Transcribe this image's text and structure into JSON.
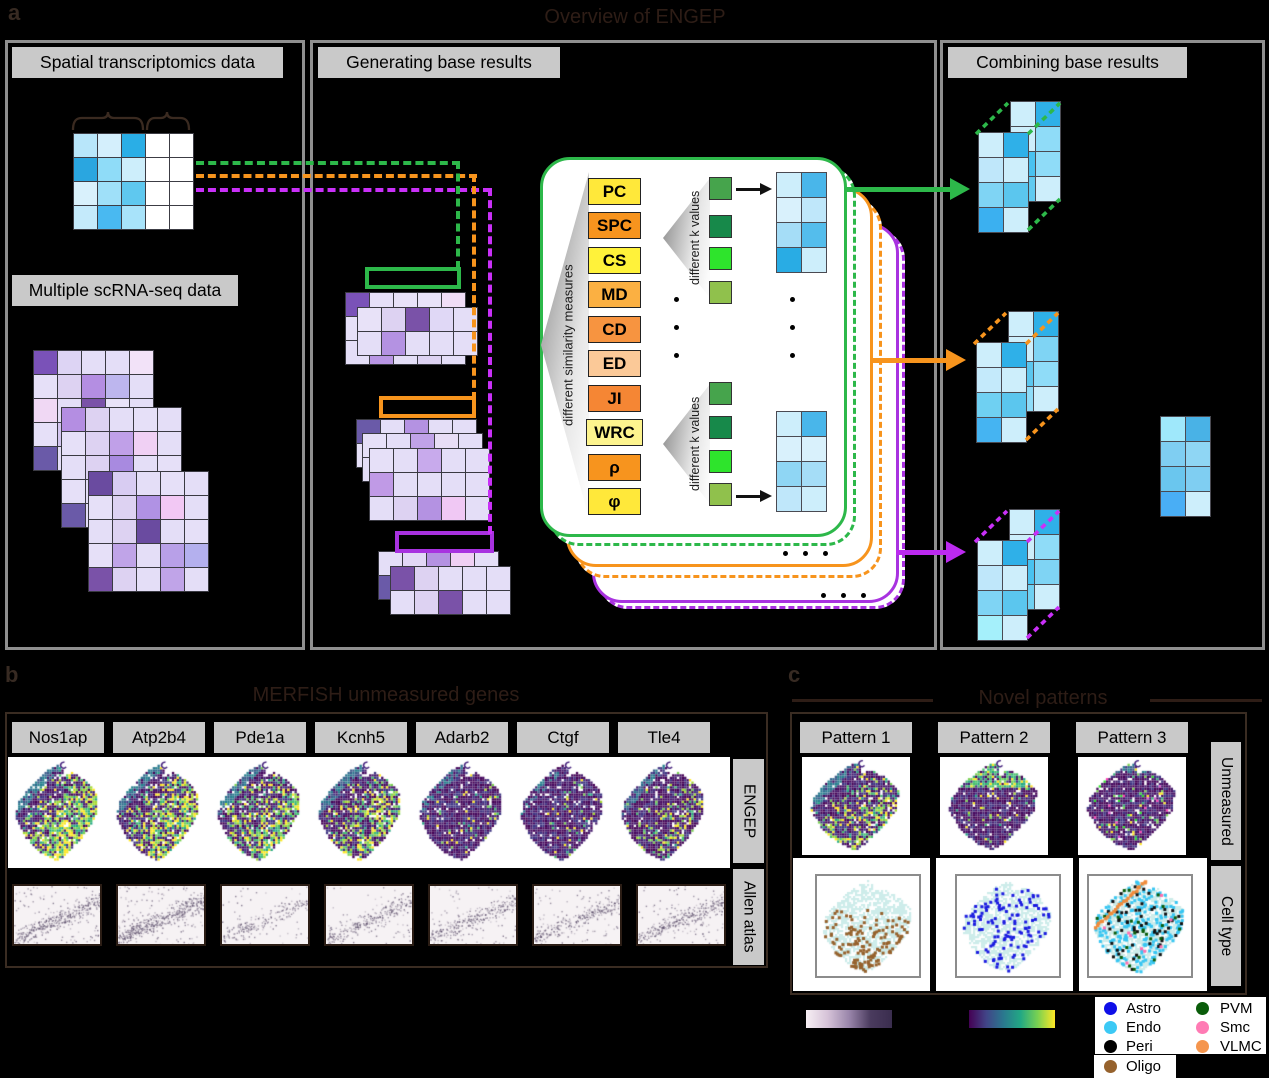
{
  "panel_a": {
    "label": "a",
    "title": "Overview of ENGEP",
    "colors": {
      "green": "#2db84a",
      "orange": "#f7941d",
      "purple": "#a832e0",
      "purple_bright": "#c930f8"
    },
    "left": {
      "title": "Spatial transcriptomics data",
      "scrna_title": "Multiple scRNA-seq data",
      "spatial_matrix": [
        [
          "#b8e6fa",
          "#d4effc",
          "#2aaee6",
          "#ffffff",
          "#ffffff"
        ],
        [
          "#2aa6e0",
          "#8fdcf8",
          "#cdeefb",
          "#ffffff",
          "#ffffff"
        ],
        [
          "#d9f1fc",
          "#9fe0f9",
          "#5fc8ef",
          "#ffffff",
          "#ffffff"
        ],
        [
          "#c4eafb",
          "#49b9f1",
          "#a8e3fa",
          "#ffffff",
          "#ffffff"
        ]
      ],
      "scrna_matrices": [
        [
          [
            "#7a52b8",
            "#ddd4f4",
            "#e4def7",
            "#e4def7",
            "#f2e2f8"
          ],
          [
            "#e6e0f8",
            "#ddd2f2",
            "#b48ee2",
            "#bdb6ee",
            "#e4def7"
          ],
          [
            "#f0d8f4",
            "#e4def7",
            "#7a52a8",
            "#e8e2f8",
            "#e4def7"
          ],
          [
            "#e6e0f8",
            "#d4c6f0",
            "#e4def7",
            "#dcd4f4",
            "#e4def7"
          ],
          [
            "#6a5aa8",
            "#e4def7",
            "#c8b4ea",
            "#e4def7",
            "#e4def7"
          ]
        ],
        [
          [
            "#b48ee2",
            "#ddd2f2",
            "#e4def7",
            "#e6e0f8",
            "#e4def7"
          ],
          [
            "#e6e0f8",
            "#ddd2f2",
            "#c0a0e8",
            "#f0d0f4",
            "#e4def7"
          ],
          [
            "#e4def7",
            "#ddd2f2",
            "#a88ae0",
            "#e4def7",
            "#e6e0f8"
          ],
          [
            "#e6e0f8",
            "#e4def7",
            "#e4def7",
            "#ddd2f2",
            "#e4def7"
          ],
          [
            "#6a5aa8",
            "#e4def7",
            "#e4def7",
            "#d0c2ee",
            "#e4def7"
          ]
        ],
        [
          [
            "#6a4ba0",
            "#d8ccf2",
            "#e4def7",
            "#e6e0f8",
            "#e4def7"
          ],
          [
            "#e6e0f8",
            "#ddd2f2",
            "#b092e4",
            "#f2c8f4",
            "#e4def7"
          ],
          [
            "#e4def7",
            "#ddd2f2",
            "#6a4ba0",
            "#e4def7",
            "#e6e0f8"
          ],
          [
            "#e6e0f8",
            "#c0a4e8",
            "#e4def7",
            "#b8a0e8",
            "#b4b0ee"
          ],
          [
            "#7a52a8",
            "#ddd2f2",
            "#e4def7",
            "#c0a4e8",
            "#e4def7"
          ]
        ]
      ]
    },
    "middle": {
      "title": "Generating base results",
      "similarity_label": "different similarity measures",
      "k_label": "different k values",
      "measures": [
        {
          "label": "PC",
          "color": "#ffe83a"
        },
        {
          "label": "SPC",
          "color": "#f7941e"
        },
        {
          "label": "CS",
          "color": "#fff23a"
        },
        {
          "label": "MD",
          "color": "#fbb042"
        },
        {
          "label": "CD",
          "color": "#f79440"
        },
        {
          "label": "ED",
          "color": "#fbc998"
        },
        {
          "label": "JI",
          "color": "#f58634"
        },
        {
          "label": "WRC",
          "color": "#fdf48e"
        },
        {
          "label": "ρ",
          "color": "#f7941e"
        },
        {
          "label": "φ",
          "color": "#ffe83a"
        }
      ],
      "k_squares": [
        "#46a44c",
        "#17894a",
        "#2ee42c",
        "#90c14c"
      ],
      "k_top_matrix": [
        [
          "#cdeefb",
          "#49b6ea"
        ],
        [
          "#d9f1fc",
          "#bfe7fa"
        ],
        [
          "#a5ddf7",
          "#54bdec"
        ],
        [
          "#29ace4",
          "#cdeefb"
        ]
      ],
      "k_bottom_matrix": [
        [
          "#cdeefb",
          "#49b6ea"
        ],
        [
          "#d9f1fc",
          "#d9f1fc"
        ],
        [
          "#8fd6f4",
          "#a5ddf7"
        ],
        [
          "#bfe7fa",
          "#cdeefb"
        ]
      ],
      "stacks": [
        {
          "color": "#2db84a",
          "layers": [
            {
              "dx": 0,
              "dy": 0,
              "rows": [
                [
                  "#7a52b8",
                  "#e6e0f8",
                  "#e8e2f8",
                  "#e8e2f8",
                  "#f0ddf6"
                ],
                [
                  "#e6e0f8",
                  "#ddd2f2",
                  "#7a52a8",
                  "#e4def7",
                  "#e4def7"
                ],
                [
                  "#e4def7",
                  "#b996e4",
                  "#e4def7",
                  "#ddd2f2",
                  "#e4def7"
                ]
              ]
            },
            {
              "dx": 12,
              "dy": 15,
              "rows": [
                [
                  "#e8e2f8",
                  "#ddd2f2",
                  "#7a52a8",
                  "#e0d8f6",
                  "#e4def7"
                ],
                [
                  "#e4def7",
                  "#b492e2",
                  "#e4def7",
                  "#e4def7",
                  "#e4def7"
                ]
              ]
            }
          ]
        },
        {
          "color": "#f7941d",
          "layers": [
            {
              "dx": 0,
              "dy": 0,
              "rows": [
                [
                  "#6a5aa8",
                  "#e4def7",
                  "#b492e2",
                  "#e4def7",
                  "#e4def7"
                ],
                [
                  "#e6e0f8",
                  "#ddd2f2",
                  "#e4def7",
                  "#e4def7",
                  "#e4def7"
                ]
              ]
            },
            {
              "dx": 6,
              "dy": 14,
              "rows": [
                [
                  "#e6e0f8",
                  "#e4def7",
                  "#c0a2e8",
                  "#e8ddf6",
                  "#e4def7"
                ],
                [
                  "#e4def7",
                  "#e4def7",
                  "#e4def7",
                  "#ddd2f2",
                  "#e4def7"
                ]
              ]
            },
            {
              "dx": 13,
              "dy": 29,
              "rows": [
                [
                  "#e6e0f8",
                  "#e4def7",
                  "#c8aaec",
                  "#e4def7",
                  "#e4def7"
                ],
                [
                  "#c09ae6",
                  "#e4def7",
                  "#e4def7",
                  "#e4def7",
                  "#e4def7"
                ],
                [
                  "#e4def7",
                  "#ddd2f2",
                  "#b492e2",
                  "#f0c8f4",
                  "#e4def7"
                ]
              ]
            }
          ]
        },
        {
          "color": "#a832e0",
          "layers": [
            {
              "dx": 0,
              "dy": 0,
              "rows": [
                [
                  "#e4def7",
                  "#e2d8f6",
                  "#b492e2",
                  "#f0d0f4",
                  "#e4def7"
                ],
                [
                  "#6a5aa8",
                  "#ddd2f2",
                  "#e4def7",
                  "#e4def7",
                  "#e4def7"
                ]
              ]
            },
            {
              "dx": 12,
              "dy": 15,
              "rows": [
                [
                  "#7a52a8",
                  "#ddd2f2",
                  "#e4def7",
                  "#e4def7",
                  "#e4def7"
                ],
                [
                  "#e4def7",
                  "#ddd2f2",
                  "#7a52a8",
                  "#e4def7",
                  "#e4def7"
                ]
              ]
            }
          ]
        }
      ]
    },
    "right": {
      "title": "Combining base results",
      "result_groups": [
        {
          "color": "#2db84a",
          "back": [
            [
              "#cdeefb",
              "#2fb0e8"
            ],
            [
              "#cdeefb",
              "#8fdcf8"
            ],
            [
              "#49c2f0",
              "#8fdcf8"
            ],
            [
              "#60caf0",
              "#cdeefb"
            ]
          ],
          "front": [
            [
              "#cdeefb",
              "#2fb0e8"
            ],
            [
              "#bfe7fa",
              "#cdeefb"
            ],
            [
              "#7fd4f4",
              "#5bc6ee"
            ],
            [
              "#3bb0f0",
              "#cdeefb"
            ]
          ]
        },
        {
          "color": "#f7941d",
          "back": [
            [
              "#cdeefb",
              "#2fb0e8"
            ],
            [
              "#cdeefb",
              "#7fd4f4"
            ],
            [
              "#5bc6ee",
              "#8fdcf8"
            ],
            [
              "#8fdcf8",
              "#cdeefb"
            ]
          ],
          "front": [
            [
              "#cdeefb",
              "#2fb0e8"
            ],
            [
              "#c4eafb",
              "#cdeefb"
            ],
            [
              "#6fd0f2",
              "#5bc6ee"
            ],
            [
              "#45b4f2",
              "#cdeefb"
            ]
          ]
        },
        {
          "color": "#c930f8",
          "back": [
            [
              "#cdeefb",
              "#2fb0e8"
            ],
            [
              "#cdeefb",
              "#8fdcf8"
            ],
            [
              "#49c2f0",
              "#7fd4f4"
            ],
            [
              "#6fd0f2",
              "#cdeefb"
            ]
          ],
          "front": [
            [
              "#cdeefb",
              "#2fb0e8"
            ],
            [
              "#bfe7fa",
              "#cdeefb"
            ],
            [
              "#7fd4f4",
              "#5bc6ee"
            ],
            [
              "#a5f0fb",
              "#cdeefb"
            ]
          ]
        }
      ],
      "final_matrix": [
        [
          "#9fe8fb",
          "#49b2e6"
        ],
        [
          "#7fcef2",
          "#8fd6f4"
        ],
        [
          "#6ac6ee",
          "#7fcef2"
        ],
        [
          "#49aef5",
          "#cdeefb"
        ]
      ]
    }
  },
  "panel_b": {
    "label": "b",
    "title": "MERFISH unmeasured genes",
    "genes": [
      "Nos1ap",
      "Atp2b4",
      "Pde1a",
      "Kcnh5",
      "Adarb2",
      "Ctgf",
      "Tle4"
    ],
    "row_labels": [
      "ENGEP",
      "Allen atlas"
    ],
    "gene_brightness": [
      0.8,
      0.7,
      0.62,
      0.55,
      0.12,
      0.08,
      0.3
    ],
    "allen_density": [
      0.8,
      1.0,
      0.45,
      0.55,
      0.6,
      0.55,
      0.65
    ]
  },
  "panel_c": {
    "label": "c",
    "title": "Novel patterns",
    "patterns": [
      "Pattern 1",
      "Pattern 2",
      "Pattern 3"
    ],
    "row_labels": [
      "Unmeasured",
      "Cell type"
    ],
    "pattern_modes": [
      "p1",
      "p2",
      "p3"
    ],
    "celltype_maps": [
      {
        "dots": [
          {
            "color": "#96622d",
            "count": 150,
            "bias": "bottom"
          }
        ]
      },
      {
        "dots": [
          {
            "color": "#1b1be0",
            "count": 125,
            "bias": "all"
          }
        ]
      },
      {
        "dots": [
          {
            "color": "#38c6f2",
            "count": 240,
            "bias": "all"
          },
          {
            "color": "#101010",
            "count": 60,
            "bias": "all"
          },
          {
            "color": "#0a5c0a",
            "count": 26,
            "bias": "all"
          },
          {
            "color": "#ff6eb0",
            "count": 9,
            "bias": "all"
          }
        ],
        "arc": "#f08c3c"
      }
    ],
    "colorbars": [
      {
        "name": "expression-purple",
        "stops": [
          "#f7eff4",
          "#d6c3d8",
          "#9a86ab",
          "#4a3b5e",
          "#3a2d4e"
        ]
      },
      {
        "name": "viridis",
        "stops": [
          "#440154",
          "#414487",
          "#2a788e",
          "#22a884",
          "#7ad151",
          "#fde725"
        ]
      }
    ],
    "legend": {
      "items": [
        {
          "label": "Astro",
          "color": "#0f0fe8"
        },
        {
          "label": "Endo",
          "color": "#3cc9f5"
        },
        {
          "label": "Peri",
          "color": "#000000"
        },
        {
          "label": "Oligo",
          "color": "#96622d"
        },
        {
          "label": "PVM",
          "color": "#0a5c0a"
        },
        {
          "label": "Smc",
          "color": "#ff7bb4"
        },
        {
          "label": "VLMC",
          "color": "#f5954d"
        }
      ]
    }
  }
}
